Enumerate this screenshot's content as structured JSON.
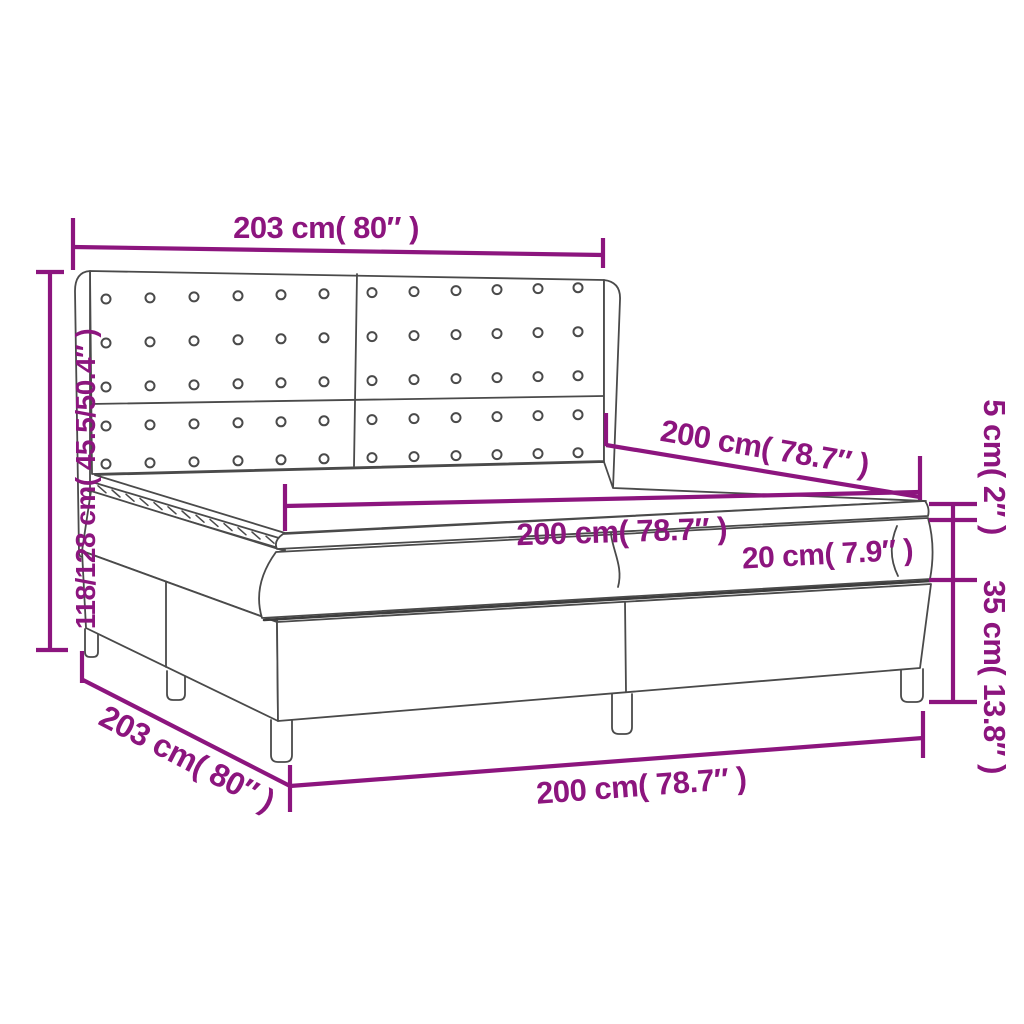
{
  "diagram": {
    "type": "product-dimension-diagram",
    "subject": "box-spring-bed-with-tufted-headboard",
    "colors": {
      "dimension_accent": "#8C157E",
      "drawing_outline": "#4A4A4A",
      "background": "#FFFFFF"
    },
    "dimensions": {
      "headboard_width_top": "203 cm( 80″ )",
      "total_height_left": "118/128 cm( 45.5/50.4″ )",
      "bed_length_depth": "200 cm( 78.7″ )",
      "mattress_length_top": "200 cm( 78.7″ )",
      "mattress_thickness": "20 cm( 7.9″ )",
      "topper_thickness": "5 cm( 2″ )",
      "base_height": "35 cm( 13.8″ )",
      "bed_width_side": "203 cm( 80″ )",
      "bed_length_bottom": "200 cm( 78.7″ )"
    }
  }
}
